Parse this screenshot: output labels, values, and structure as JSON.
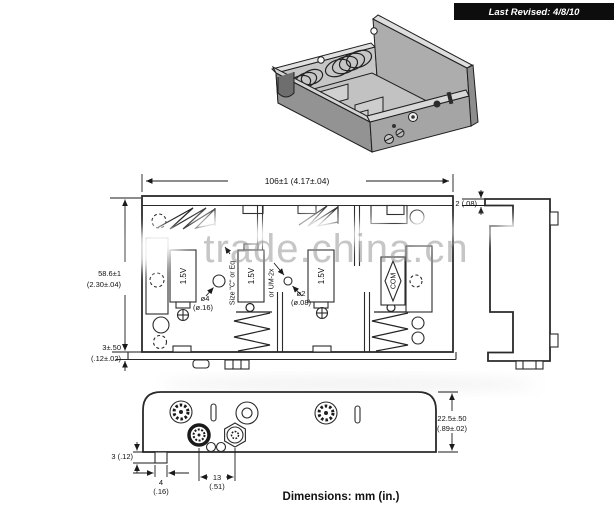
{
  "header": {
    "last_revised": "Last Revised:  4/8/10"
  },
  "watermark": {
    "text": "trade.china.cn"
  },
  "views": {
    "front": {
      "dim_width": "106±1 (4.17±.04)",
      "dim_height_mm": "58.6±1",
      "dim_height_in": "(2.30±.04)",
      "dim_base_mm": "3±.50",
      "dim_base_in": "(.12±.02)",
      "dim_lip": "2 (.08)",
      "cell_voltage": "1.5V",
      "size_note_1": "Size \"C\" or Eq",
      "size_note_2": "or UM-2x",
      "hole4_mm": "ø4",
      "hole4_in": "(ø.16)",
      "hole2_mm": "ø2",
      "hole2_in": "(ø.08)",
      "com": "COM"
    },
    "bottom": {
      "dim_height_mm": "22.5±.50",
      "dim_height_in": "(.89±.02)",
      "dim_tab_h": "3 (.12)",
      "dim_tab_w_mm": "4",
      "dim_tab_w_in": "(.16)",
      "dim_pitch_mm": "13",
      "dim_pitch_in": "(.51)"
    }
  },
  "footer": {
    "note": "Dimensions: mm (in.)"
  },
  "colors": {
    "ink": "#1c1c1c",
    "banner_bg": "#0d0d0d",
    "banner_fg": "#ffffff",
    "watermark": "#8f8f8f",
    "metal_light": "#d8d8d8",
    "metal_mid": "#a8a8a8",
    "metal_dark": "#7e7e7e"
  }
}
